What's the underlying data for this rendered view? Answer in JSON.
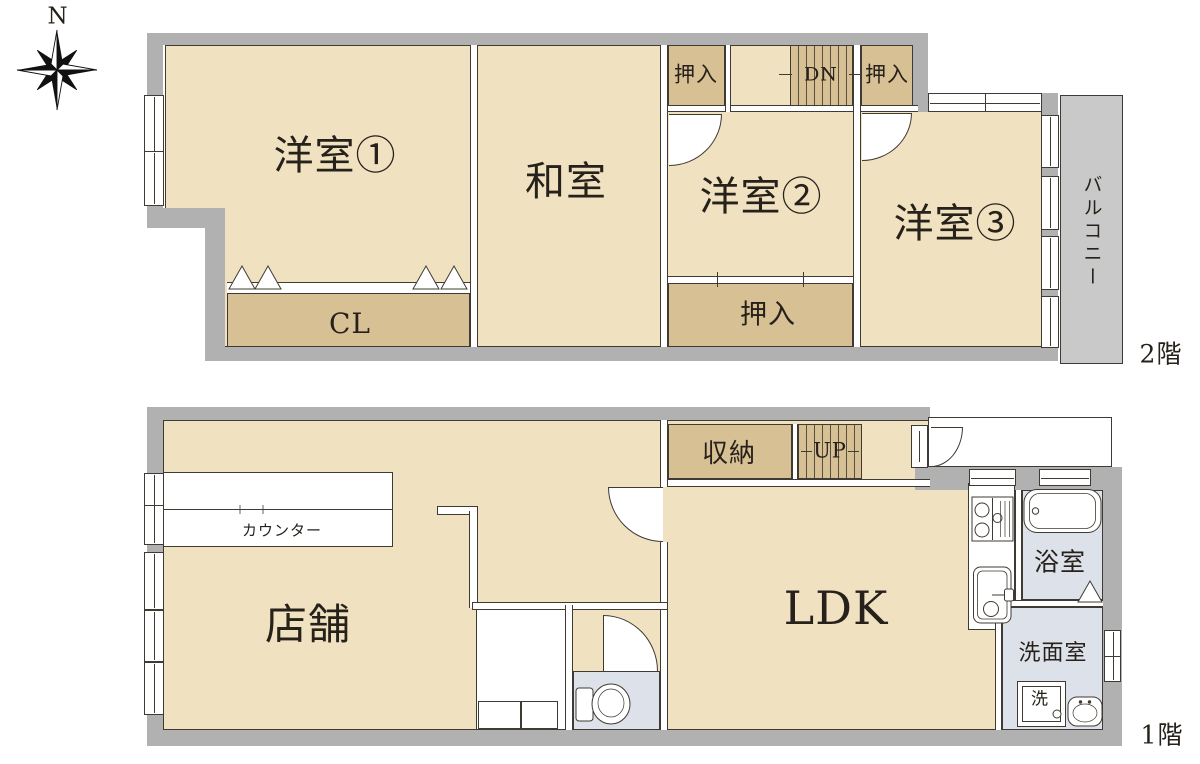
{
  "compass": {
    "north": "N"
  },
  "floor2": {
    "label": "2階",
    "rooms": {
      "yoshitsu1": "洋室①",
      "washitsu": "和室",
      "yoshitsu2": "洋室②",
      "yoshitsu3": "洋室③",
      "closet_cl": "CL",
      "oshiire_top_left": "押入",
      "oshiire_top_right": "押入",
      "oshiire_bottom": "押入",
      "stairs_down": "DN",
      "balcony": "バルコニー"
    }
  },
  "floor1": {
    "label": "1階",
    "rooms": {
      "shop": "店舗",
      "counter": "カウンター",
      "storage": "収納",
      "stairs_up": "UP",
      "ldk": "LDK",
      "bathroom": "浴室",
      "washroom": "洗面室",
      "washer": "洗"
    }
  },
  "colors": {
    "exterior_wall": "#b1b1b1",
    "room_floor": "#f0e1c1",
    "closet_floor": "#d8c095",
    "wet_area_floor": "#dde1ea",
    "balcony_floor": "#c9c9c9",
    "outline": "#3f3a33",
    "text": "#26211a"
  }
}
